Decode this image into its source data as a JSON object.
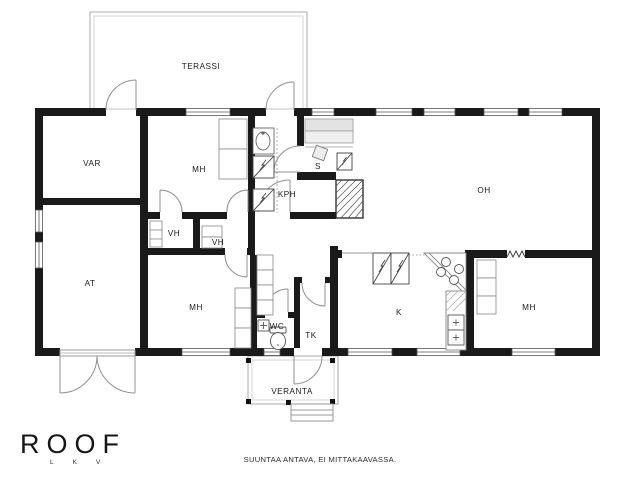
{
  "floorplan": {
    "rooms": {
      "terassi": "TERASSI",
      "var": "VAR",
      "mh_top": "MH",
      "kph": "KPH",
      "sauna": "S",
      "oh": "OH",
      "vh1": "VH",
      "vh2": "VH",
      "at": "AT",
      "mh_lower": "MH",
      "wc": "WC",
      "tk": "TK",
      "kitchen": "K",
      "mh_right": "MH",
      "veranta": "VERANTA"
    },
    "colors": {
      "wall": "#1a1a1a",
      "thin_line": "#9a9a9a",
      "bench_fill": "#e3e3e3"
    }
  },
  "branding": {
    "logo_text": "ROOF",
    "logo_subtext": "LKV"
  },
  "footer": {
    "disclaimer": "SUUNTAA ANTAVA, EI MITTAKAAVASSA."
  }
}
